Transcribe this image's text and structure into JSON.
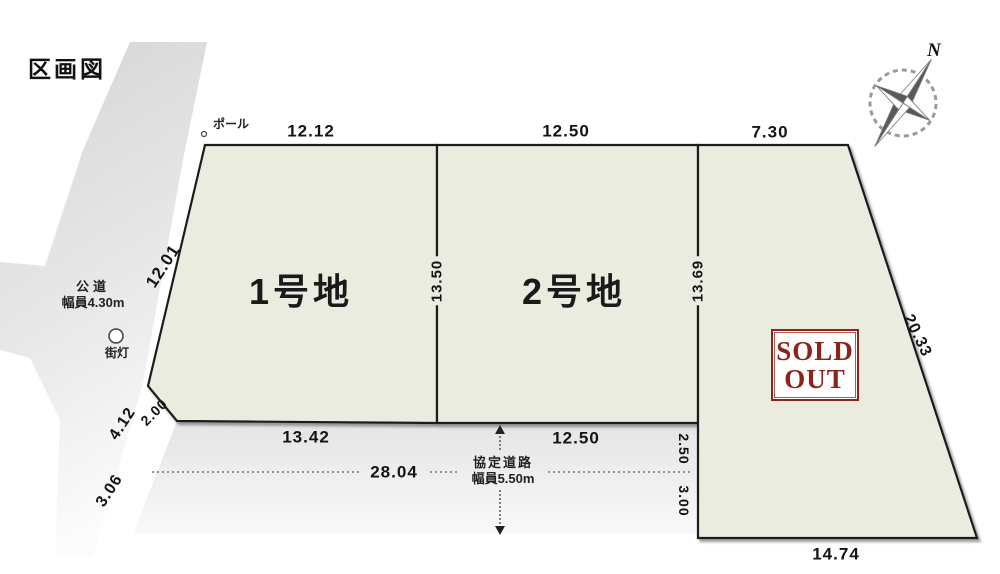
{
  "title": "区画図",
  "compass": {
    "north_label": "N"
  },
  "roads": {
    "public_road": {
      "name": "公道",
      "width_label": "幅員4.30m"
    },
    "agreement_road": {
      "name": "協定道路",
      "width_label": "幅員5.50m"
    },
    "street_light_label": "街灯",
    "pole_label": "ポール"
  },
  "lots": {
    "lot1": {
      "name": "1号地"
    },
    "lot2": {
      "name": "2号地"
    },
    "lot3": {
      "sold_line1": "SOLD",
      "sold_line2": "OUT"
    }
  },
  "dimensions": {
    "top_lot1": "12.12",
    "top_lot2": "12.50",
    "top_lot3": "7.30",
    "left_upper": "12.01",
    "left_lower": "4.12",
    "bevel": "2.00",
    "left_road_lower": "3.06",
    "divider_lot1_lot2": "13.50",
    "divider_lot2_lot3": "13.69",
    "bottom_lot1": "13.42",
    "bottom_lot2": "12.50",
    "road_total": "28.04",
    "road_upper_half": "2.50",
    "road_lower_half": "3.00",
    "lot3_right": "20.33",
    "lot3_bottom": "14.74"
  },
  "colors": {
    "lot_fill": "#e9ecdf",
    "outline": "#1c1c1c",
    "sold_out_red": "#8e231b",
    "road_gray": "#d9d9d9",
    "agreement_road_gray": "#e6e6e6"
  }
}
